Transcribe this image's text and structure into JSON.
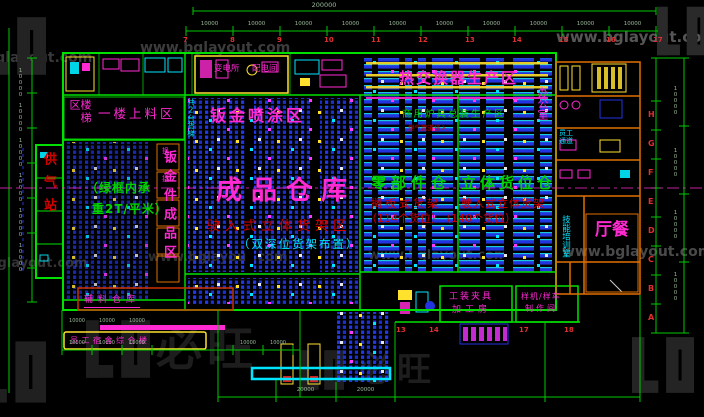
{
  "watermark": {
    "url": "www.bglayout.com",
    "brand": "必旺"
  },
  "areas": {
    "gas_station": "供气站",
    "stairs": "楼梯区",
    "first_floor_loading": "一楼上料区",
    "elevator_note": "共2台货梯",
    "sheet_metal_zone": "钣金件成品区",
    "load_note_1": "（绿框内承",
    "load_note_2": "重2T/平米）",
    "spray_area": "钣金喷涂区",
    "substation": "变电所",
    "power_room": "配电间",
    "heat_exchange": "热交换器生产区",
    "stove_line": "商用炉具总装生产区",
    "gas_note": "燃气管道接入",
    "finished_goods": "成品仓库",
    "finished_note_1": "驶入式立体货架区",
    "finished_note_2": "（双深位货架布置）",
    "parts_warehouse": "零部件仓",
    "parts_note_1": "搁板式货架",
    "parts_note_2": "（114个货位）",
    "highbay_warehouse": "立体货位仓",
    "highbay_note_1": "驶入式立体货架",
    "highbay_note_2": "（140个货位）",
    "office": "办公室",
    "staff_passage": "员工通道",
    "training_room": "技能培训室",
    "canteen": "餐厅",
    "tooling_room_1": "工装夹具",
    "tooling_room_2": "加工房",
    "prototype_room_1": "样机/样车",
    "prototype_room_2": "制作间",
    "aux_warehouse": "辅料仓库",
    "complex_building": "员工宿舍综合楼",
    "corridor_room_1": "换",
    "corridor_room_2": "接"
  },
  "dims": {
    "total": "200000",
    "seg": "10000",
    "dock": "20000",
    "top_grid": [
      "7",
      "8",
      "9",
      "10",
      "11",
      "12",
      "13",
      "14",
      "15",
      "16",
      "17"
    ],
    "bottom_grid": [
      "13",
      "14",
      "17",
      "18"
    ],
    "right_grid": [
      "H",
      "G",
      "F",
      "E",
      "D",
      "C",
      "B",
      "A"
    ]
  },
  "colors": {
    "background": "#000000",
    "dimension_green": "#00c800",
    "wall_green": "#00e000",
    "label_magenta": "#ff2ad2",
    "label_red": "#d40000",
    "label_cyan": "#00e5ff",
    "label_green": "#00d400",
    "label_yellow": "#ffe12e",
    "rack_blue": "#2233e0",
    "wall_orange": "#e07000",
    "dim_text": "#9ab89a",
    "grid_red": "#e03030",
    "watermark_gray": "#2e2e2e"
  }
}
